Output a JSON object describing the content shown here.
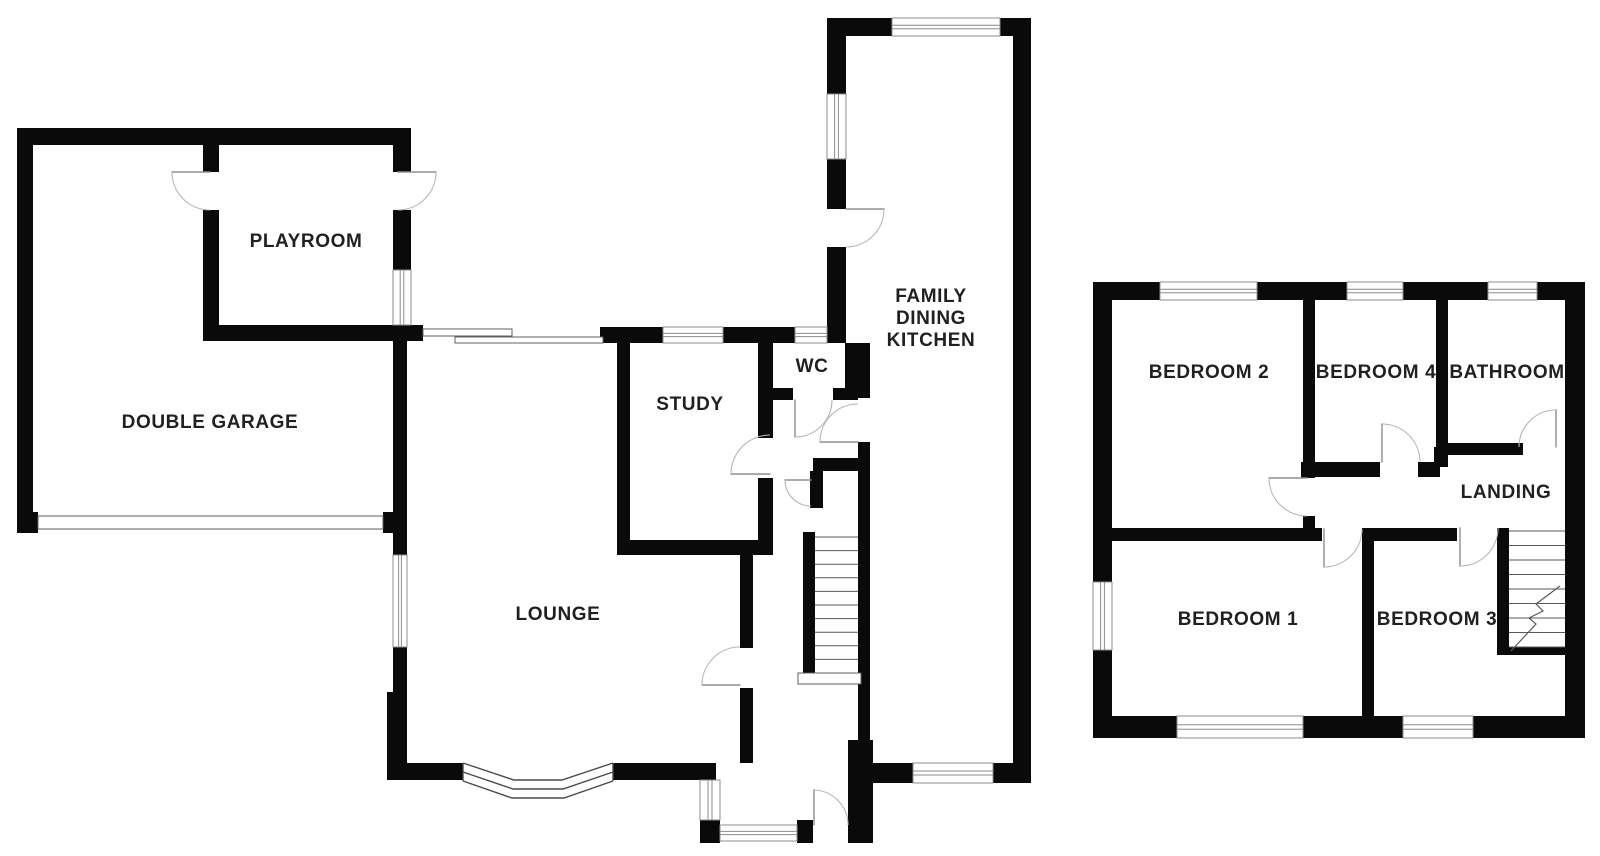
{
  "colors": {
    "background": "#ffffff",
    "wall": "#0a0a0a",
    "label_text": "#231f20",
    "door_arc": "#b5b5b5",
    "door_leaf": "#8f8f8f",
    "window_line": "#8c8c8c",
    "stair_line": "#5a5a5a"
  },
  "ground_floor": {
    "playroom": "PLAYROOM",
    "double_garage": "DOUBLE GARAGE",
    "study": "STUDY",
    "wc": "WC",
    "family_dining_kitchen": [
      "FAMILY",
      "DINING",
      "KITCHEN"
    ],
    "lounge": "LOUNGE"
  },
  "first_floor": {
    "bedroom_2": "BEDROOM 2",
    "bedroom_4": "BEDROOM 4",
    "bathroom": "BATHROOM",
    "landing": "LANDING",
    "bedroom_1": "BEDROOM 1",
    "bedroom_3": "BEDROOM 3"
  }
}
